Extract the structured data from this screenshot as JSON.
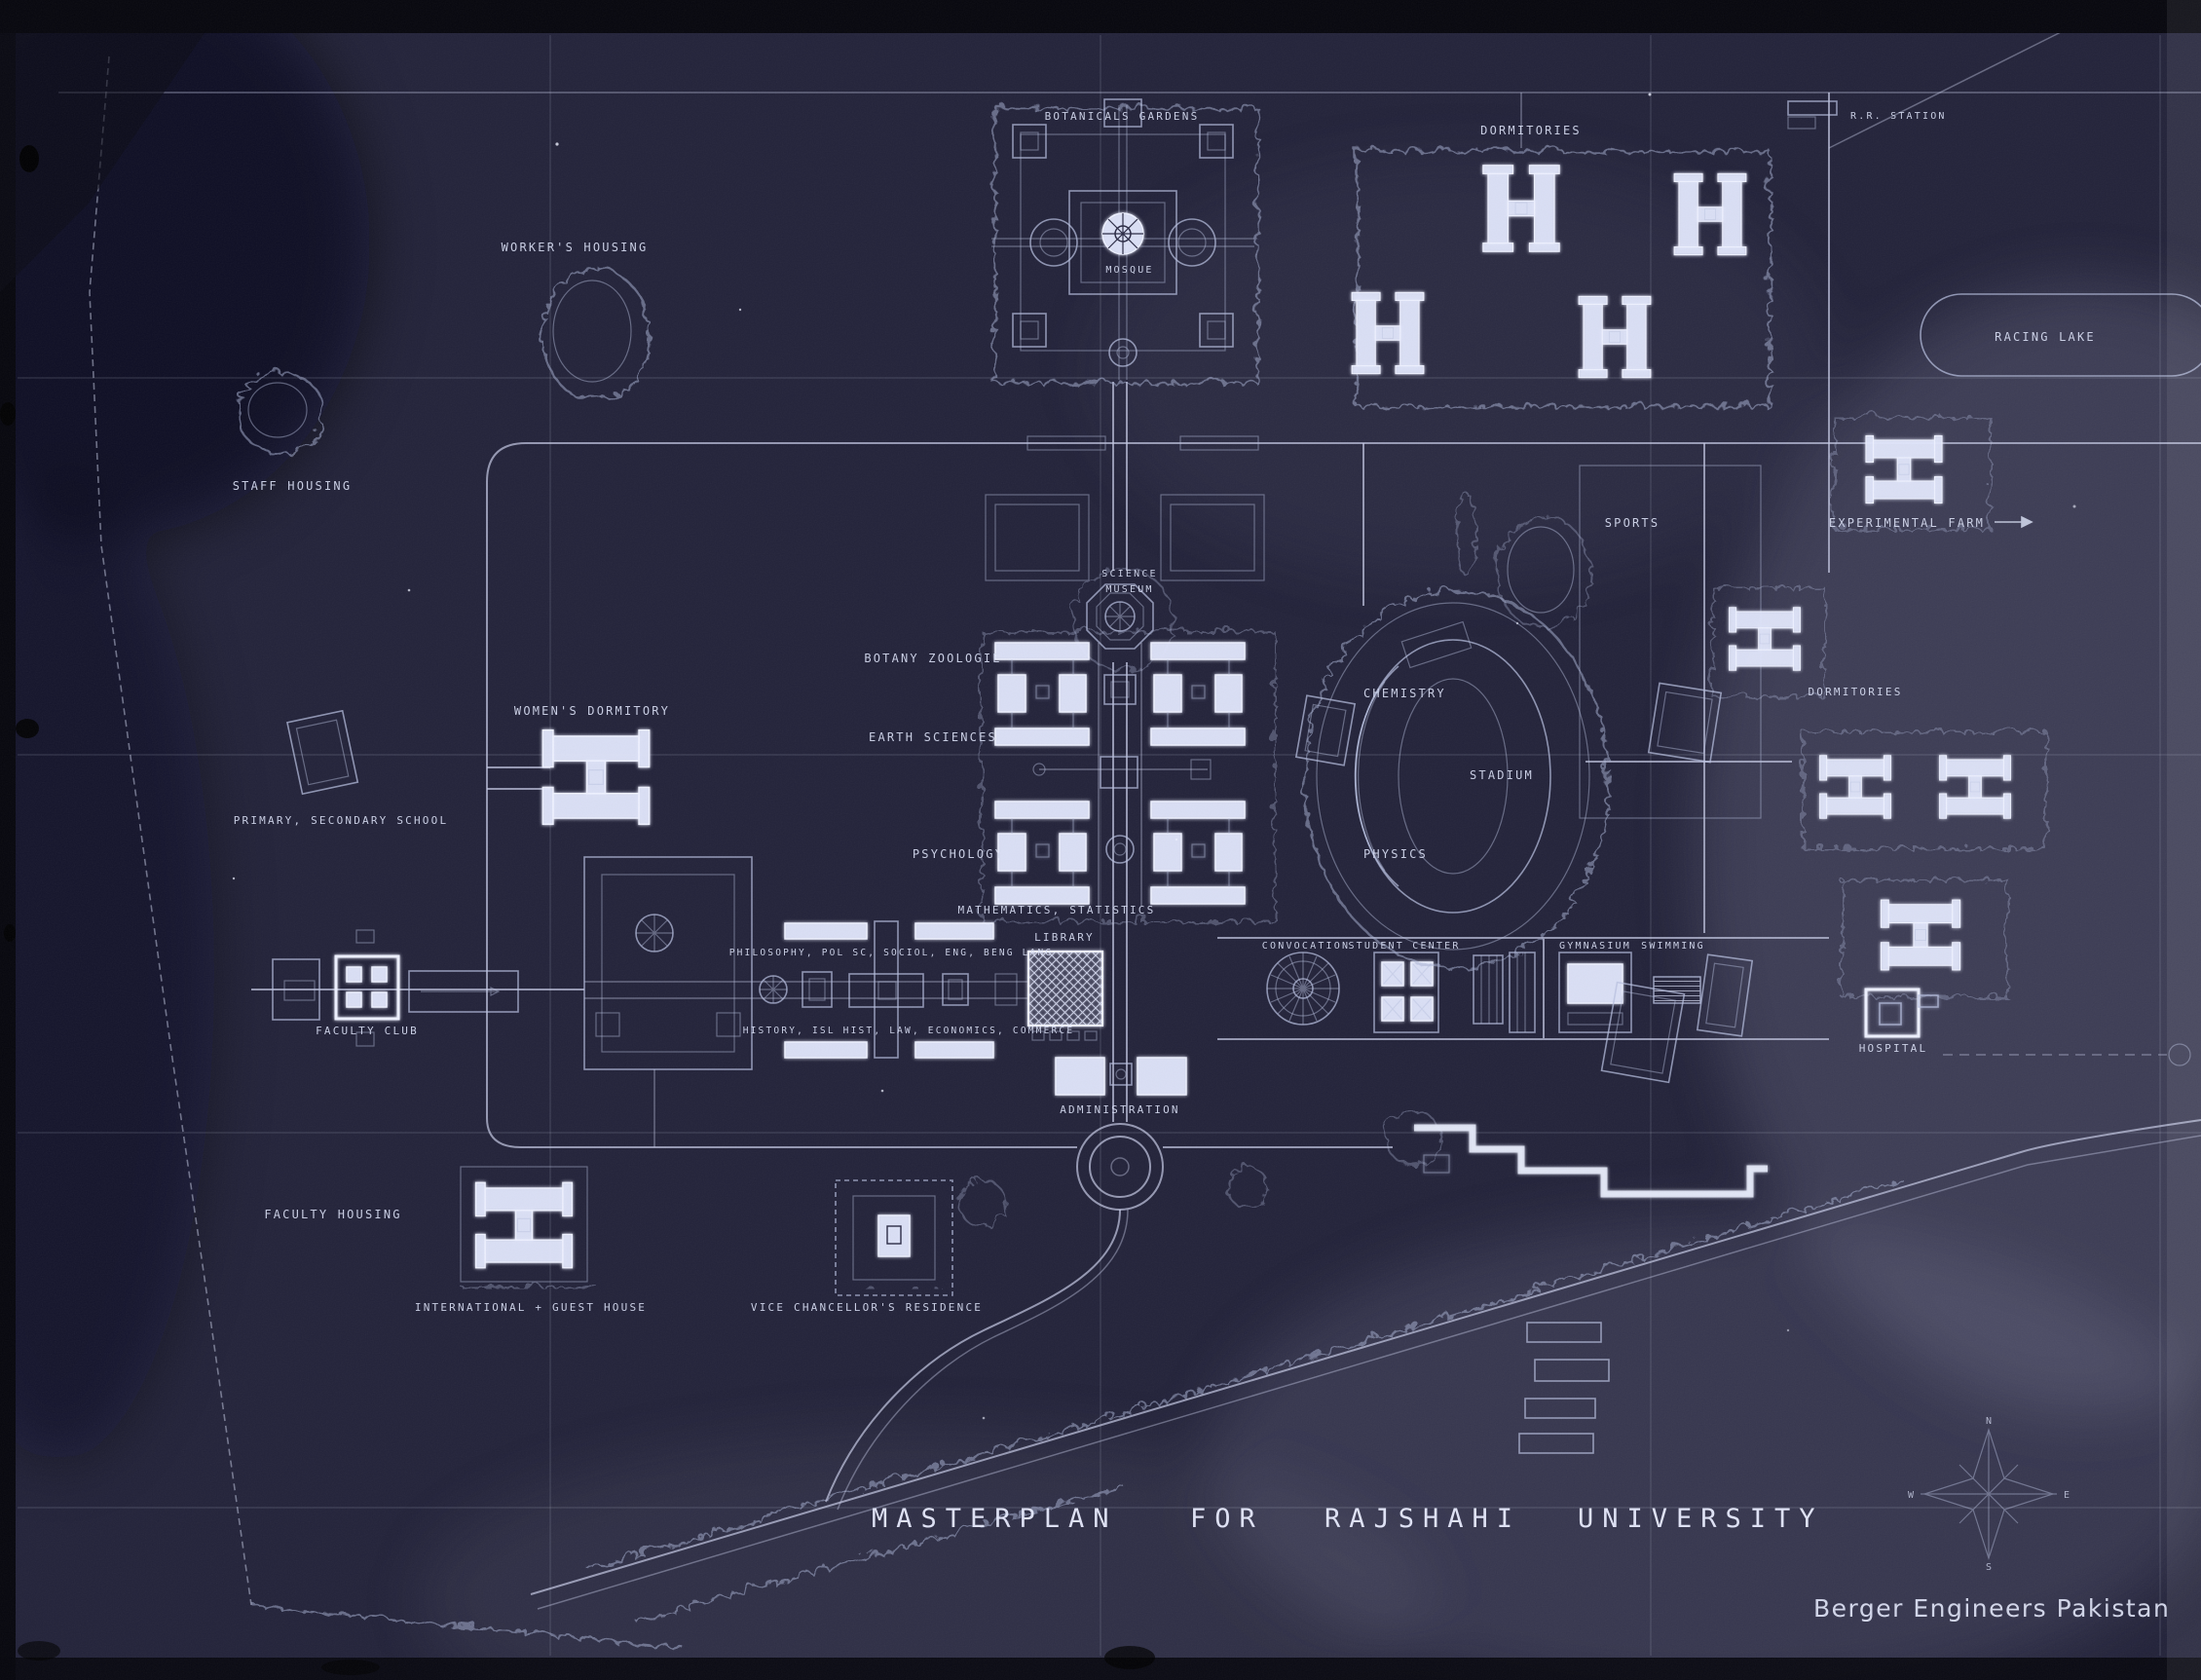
{
  "document": {
    "kind": "campus masterplan blueprint photograph",
    "title_words": [
      "MASTERPLAN",
      "FOR",
      "RAJSHAHI",
      "UNIVERSITY"
    ],
    "credit": "Berger  Engineers  Pakistan"
  },
  "compass": {
    "n": "N",
    "e": "E",
    "s": "S",
    "w": "W"
  },
  "colors": {
    "background": "#23233a",
    "line_ink": "#c6cbe6",
    "bright_ink": "#eef1ff",
    "label_ink": "#d8def4"
  },
  "labels": {
    "botanical_gardens": "BOTANICALS GARDENS",
    "mosque": "MOSQUE",
    "dormitories_north": "DORMITORIES",
    "rr_station": "R.R. STATION",
    "racing_lake": "RACING LAKE",
    "workers_housing": "WORKER'S HOUSING",
    "staff_housing": "STAFF HOUSING",
    "experimental_farm": "EXPERIMENTAL FARM",
    "sports": "SPORTS",
    "science": "SCIENCE",
    "museum": "MUSEUM",
    "botany_zoologie": "BOTANY ZOOLOGIE",
    "chemistry": "CHEMISTRY",
    "earth_sciences": "EARTH SCIENCES",
    "womens_dormitory": "WOMEN'S DORMITORY",
    "primary_secondary_school": "PRIMARY, SECONDARY SCHOOL",
    "stadium": "STADIUM",
    "dormitories_east": "DORMITORIES",
    "psychology": "PSYCHOLOGY",
    "physics": "PHYSICS",
    "mathematics_statistics": "MATHEMATICS, STATISTICS",
    "library": "LIBRARY",
    "humanities_north": "PHILOSOPHY, POL SC, SOCIOL, ENG, BENG LANG",
    "humanities_south": "HISTORY, ISL HIST, LAW, ECONOMICS, COMMERCE",
    "faculty_club": "FACULTY CLUB",
    "convocation": "CONVOCATION",
    "student_center": "STUDENT CENTER",
    "gymnasium": "GYMNASIUM",
    "swimming": "SWIMMING",
    "hospital": "HOSPITAL",
    "administration": "ADMINISTRATION",
    "faculty_housing": "FACULTY HOUSING",
    "international_guest_house": "INTERNATIONAL + GUEST HOUSE",
    "vice_chancellors_residence": "VICE CHANCELLOR'S RESIDENCE"
  }
}
